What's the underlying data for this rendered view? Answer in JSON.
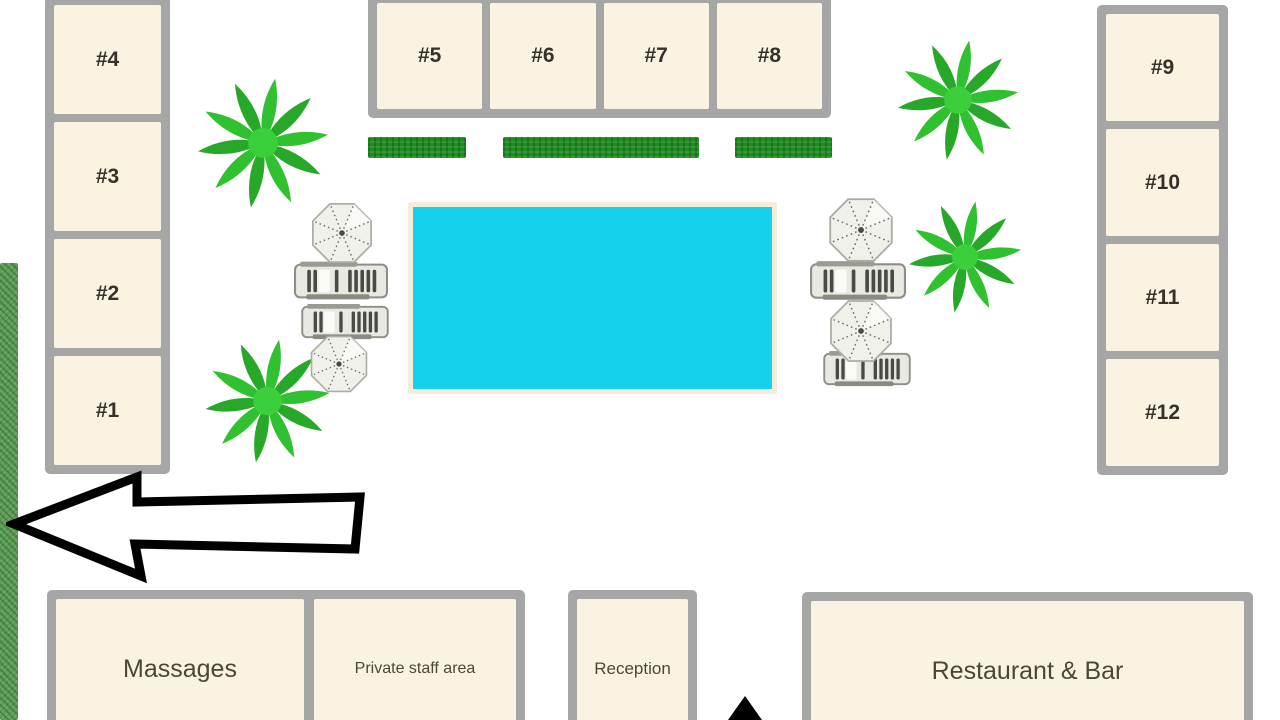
{
  "map": {
    "title": "Resort pool site plan",
    "rooms": {
      "left": [
        {
          "label": "#4"
        },
        {
          "label": "#3"
        },
        {
          "label": "#2"
        },
        {
          "label": "#1"
        }
      ],
      "top": [
        {
          "label": "#5"
        },
        {
          "label": "#6"
        },
        {
          "label": "#7"
        },
        {
          "label": "#8"
        }
      ],
      "right": [
        {
          "label": "#9"
        },
        {
          "label": "#10"
        },
        {
          "label": "#11"
        },
        {
          "label": "#12"
        }
      ]
    },
    "buildings": [
      {
        "id": "massages",
        "label": "Massages"
      },
      {
        "id": "private-staff-area",
        "label": "Private staff area"
      },
      {
        "id": "reception",
        "label": "Reception"
      },
      {
        "id": "restaurant-bar",
        "label": "Restaurant & Bar"
      }
    ],
    "features": {
      "pool": "swimming-pool",
      "palm_trees": 4,
      "umbrellas": 4,
      "lounger_groups": 4,
      "hedges": 3,
      "exit_arrow_direction": "left",
      "entrance_arrow_direction": "up"
    },
    "colors": {
      "pool": "#16D1ED",
      "room_fill": "#FAF3E2",
      "border_gray": "#A6A6A6",
      "hedge_green": "#1F8C1F",
      "grass_green": "#5E9D56",
      "palm_green": "#2FC12F",
      "arrow_outline": "#000000"
    }
  }
}
